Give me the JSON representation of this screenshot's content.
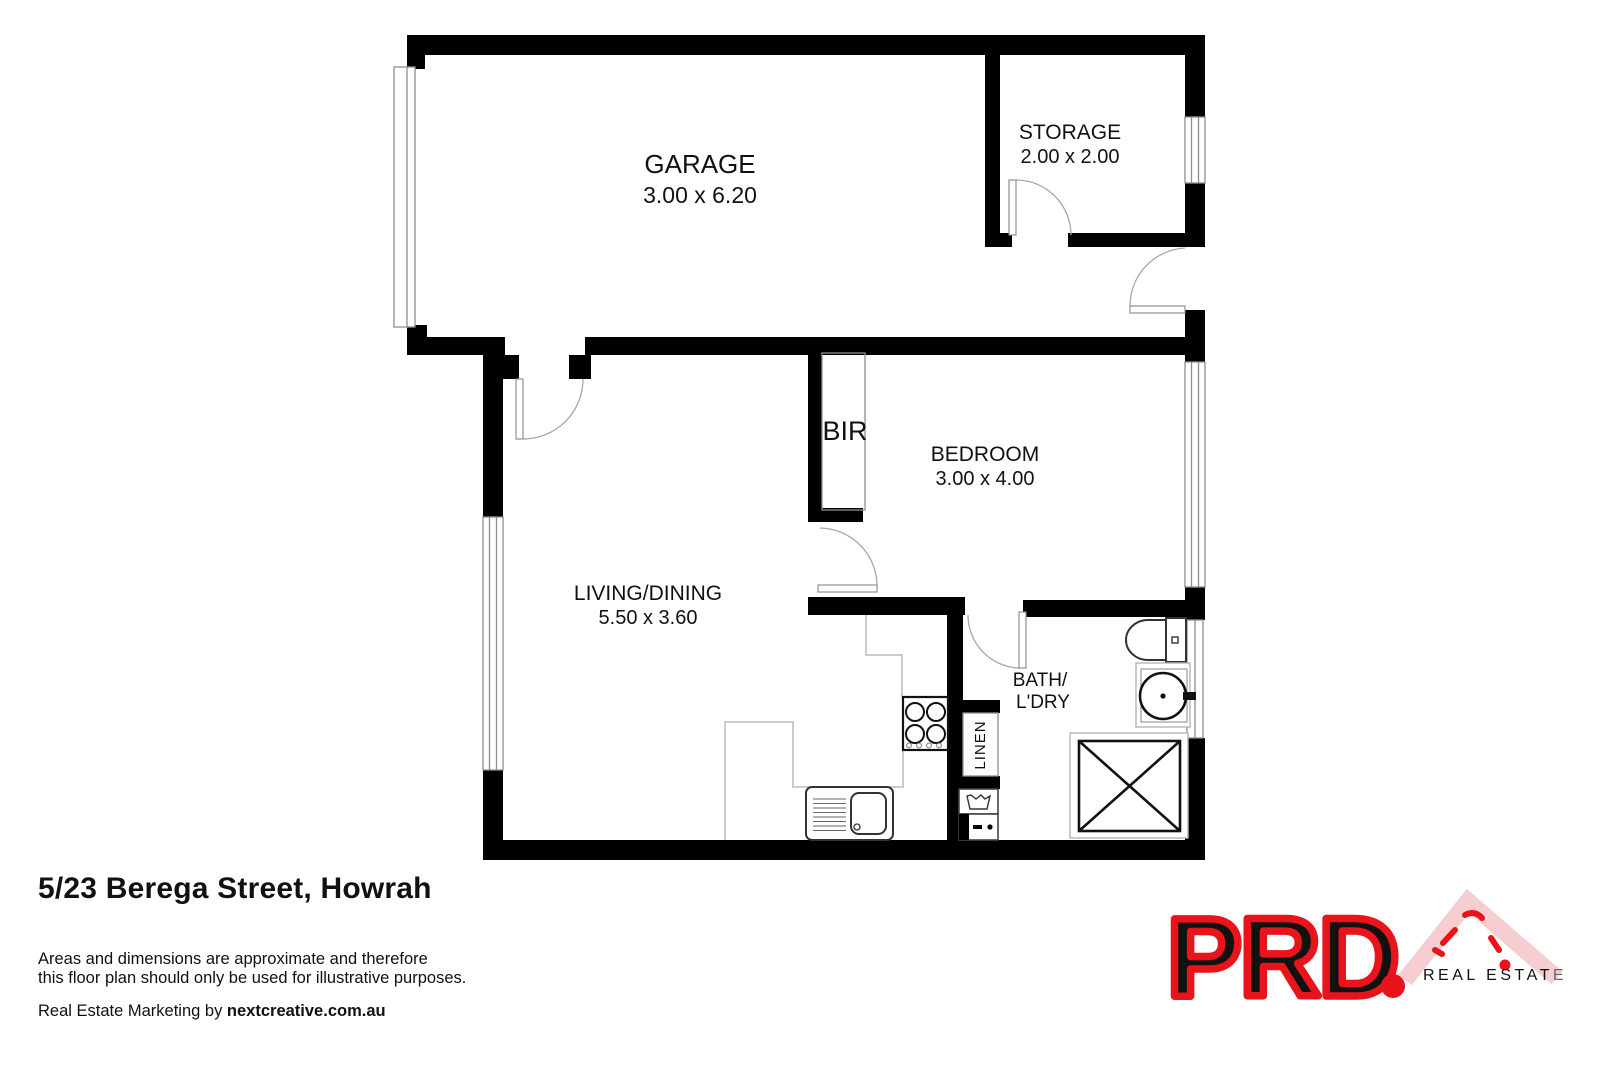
{
  "rooms": {
    "garage": {
      "label": "GARAGE",
      "dims": "3.00 x 6.20"
    },
    "storage": {
      "label": "STORAGE",
      "dims": "2.00 x 2.00"
    },
    "bir": {
      "label": "BIR"
    },
    "bedroom": {
      "label": "BEDROOM",
      "dims": "3.00 x 4.00"
    },
    "living": {
      "label": "LIVING/DINING",
      "dims": "5.50 x 3.60"
    },
    "bath": {
      "line1": "BATH/",
      "line2": "L'DRY"
    },
    "linen": {
      "label": "LINEN"
    }
  },
  "footer": {
    "address": "5/23 Berega Street, Howrah",
    "disclaimer_line1": "Areas and dimensions are approximate and therefore",
    "disclaimer_line2": "this floor plan should only be used for illustrative purposes.",
    "marketing_prefix": "Real Estate Marketing by ",
    "marketing_brand": "nextcreative.com.au"
  },
  "logo": {
    "brand": "PRD",
    "tagline_main": "REAL ESTAT",
    "tagline_last": "E",
    "brand_color": "#e8131b",
    "roof_color": "#f6ced2",
    "tagline_color": "#c9c9c9",
    "tagline_last_color": "#6a6a6a"
  },
  "colors": {
    "wall": "#000000",
    "thin_line": "#8f8f8f",
    "bench_line": "#bcbcbc",
    "text": "#111111"
  }
}
